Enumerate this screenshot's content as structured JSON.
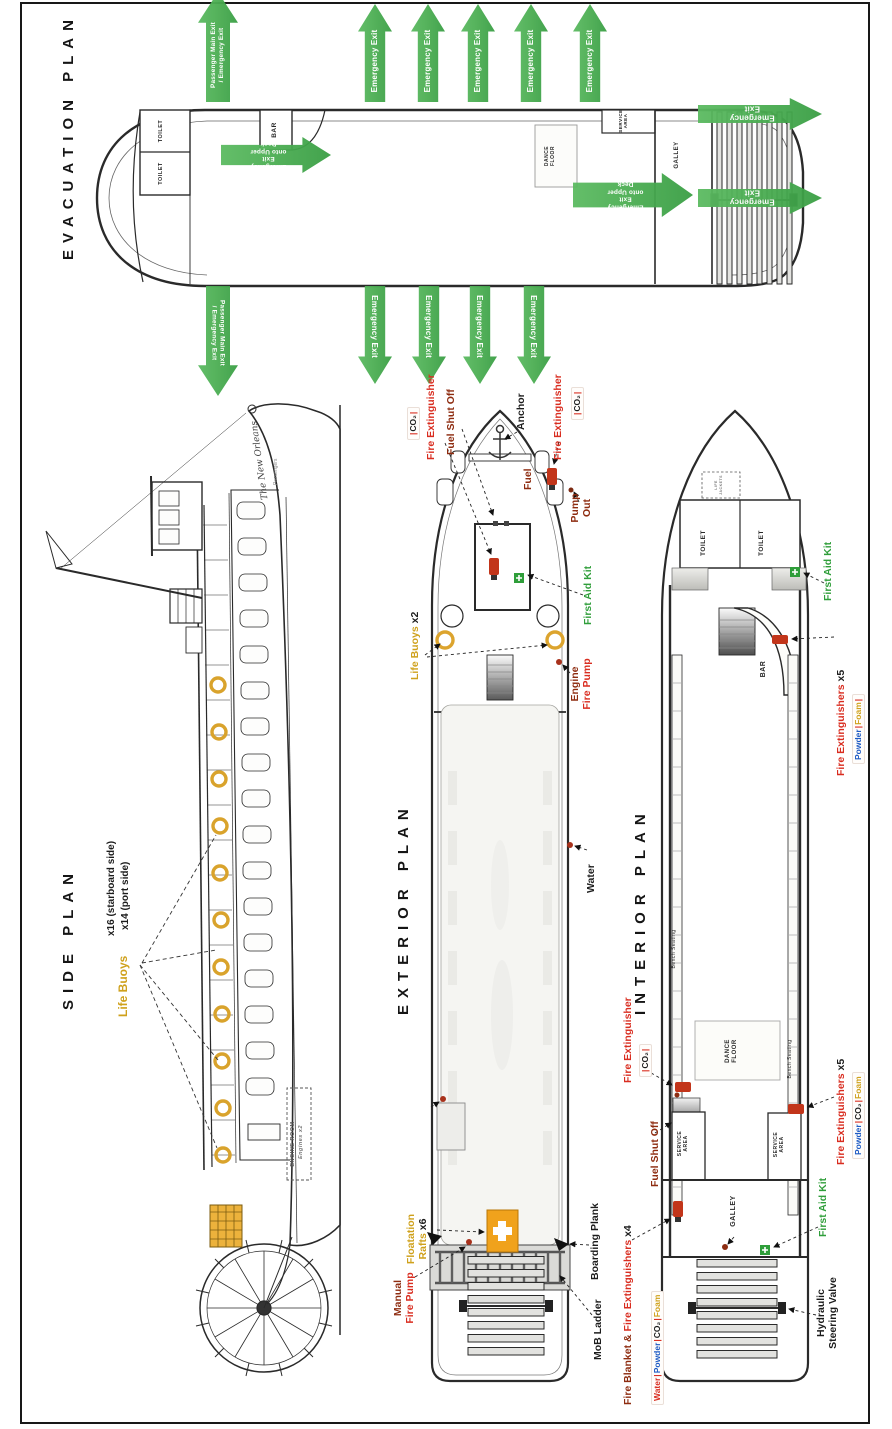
{
  "palette": {
    "green": "#43ac4b",
    "red": "#d92d20",
    "dark_red": "#8e2c10",
    "gold": "#cfa11c",
    "blue": "#1f5bc4",
    "orange": "#f0a21c",
    "black": "#1c1c1c",
    "gray": "#8d8d8d"
  },
  "evacuation": {
    "title": "EVACUATION PLAN",
    "rooms": {
      "toilet_a": "TOILET",
      "toilet_b": "TOILET",
      "bar": "BAR",
      "dance_1": "DANCE",
      "dance_2": "FLOOR",
      "service_1": "SERVICE",
      "service_2": "AREA",
      "galley": "GALLEY"
    },
    "arrows": {
      "passenger_main_1": "Passenger Main Exit",
      "passenger_main_2": "/ Emergency Exit",
      "emergency": "Emergency Exit",
      "upper_deck_1": "Emergency Exit",
      "upper_deck_2": "onto Upper Deck"
    }
  },
  "side": {
    "title": "SIDE PLAN",
    "life_buoys": "Life Buoys",
    "starboard": "x16 (starboard side)",
    "port": "x14 (port side)",
    "boat_name": "The New Orleans",
    "passengers": "Passengers",
    "engine_room": "ENGINE ROOM",
    "engines": "Engines x2"
  },
  "exterior": {
    "title": "EXTERIOR PLAN",
    "anchor": "Anchor",
    "fuel_shut_off": "Fuel Shut Off",
    "fire_extinguisher": "Fire Extinguisher",
    "co2": "CO₂",
    "pump_out": "Pump Out",
    "fuel": "Fuel",
    "first_aid_kit": "First Aid Kit",
    "life_buoys": "Life Buoys",
    "life_buoys_count": "x2",
    "engine": "Engine",
    "fire_pump": "Fire Pump",
    "manual": "Manual",
    "water": "Water",
    "boarding_plank": "Boarding Plank",
    "mob_ladder": "MoB Ladder",
    "floatation": "Floatation",
    "rafts": "Rafts",
    "rafts_count": "x6"
  },
  "interior": {
    "title": "INTERIOR PLAN",
    "toilet_a": "TOILET",
    "toilet_b": "TOILET",
    "bar": "BAR",
    "galley": "GALLEY",
    "dance_1": "DANCE",
    "dance_2": "FLOOR",
    "service_1": "SERVICE",
    "service_2": "AREA",
    "bench": "Bench Seating",
    "bow_locker": "LIFE JACKETS",
    "first_aid_kit": "First Aid Kit",
    "fire_extinguisher": "Fire Extinguisher",
    "fire_extinguishers": "Fire Extinguishers",
    "x5": "x5",
    "x4": "x4",
    "fire_blanket": "Fire Blanket",
    "amp": "&",
    "fuel_shut_off": "Fuel Shut Off",
    "powder": "Powder",
    "foam": "Foam",
    "co2": "CO₂",
    "water": "Water",
    "hydraulic_1": "Hydraulic",
    "hydraulic_2": "Steering Valve"
  }
}
